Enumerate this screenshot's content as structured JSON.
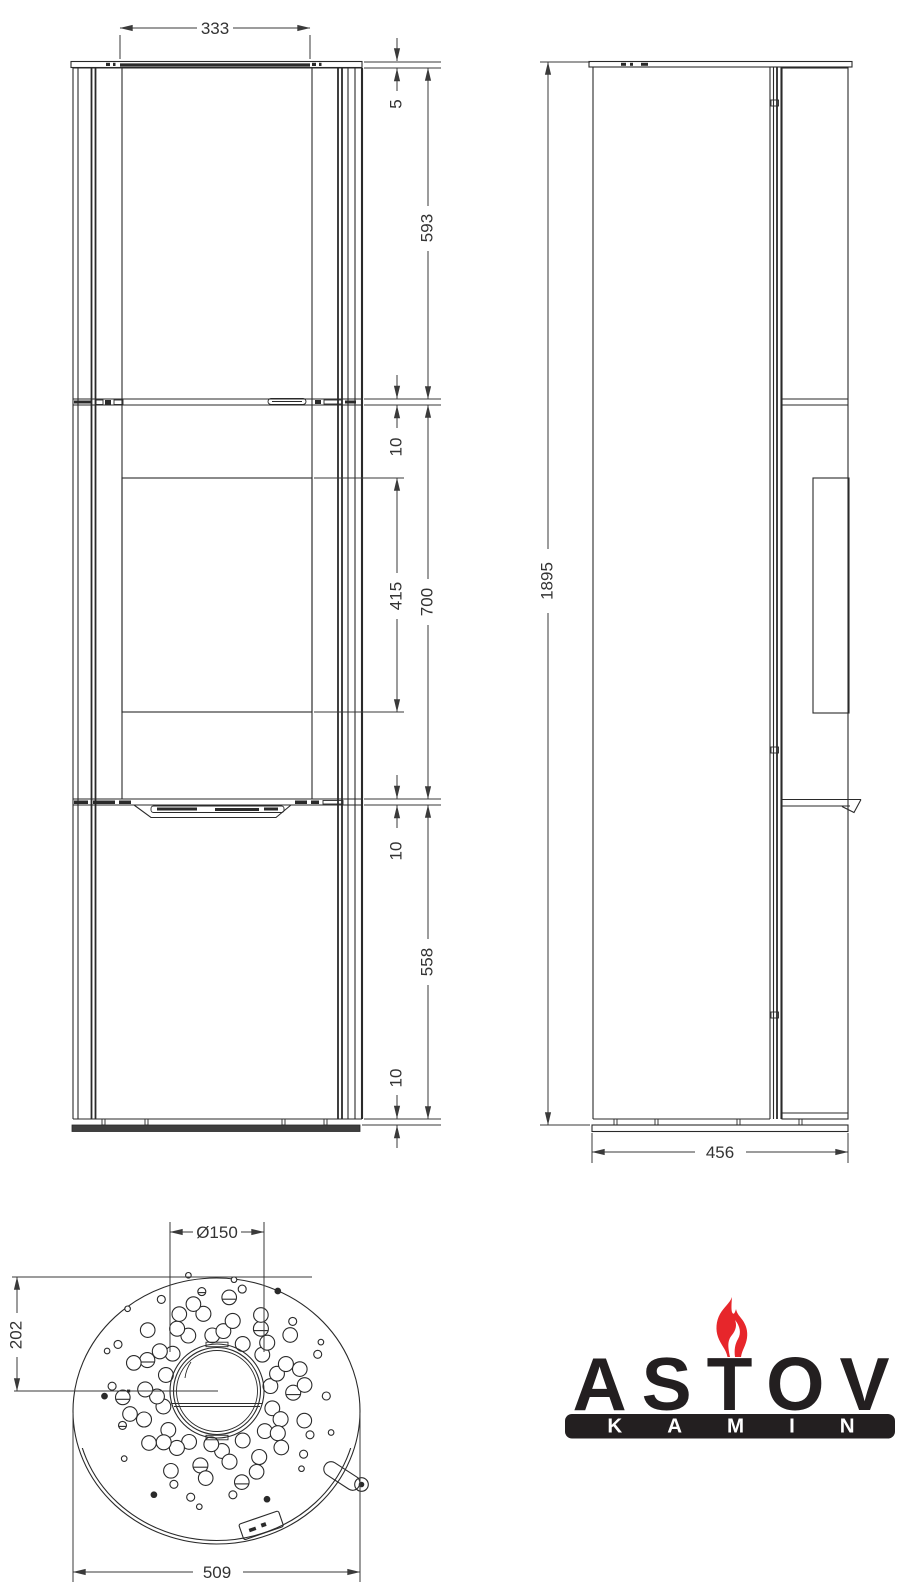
{
  "title": "Stove dimensional drawing",
  "colors": {
    "line": "#2a2a2a",
    "dim_text": "#333333",
    "logo_dark": "#231f20",
    "flame_red": "#e7262b",
    "base_fill": "#3f3f3f"
  },
  "views": {
    "front": {
      "name": "front-view",
      "dims": {
        "door_width": "333",
        "top_plate": "5",
        "upper_section": "593",
        "gap_upper": "10",
        "glass_height": "415",
        "middle_section": "700",
        "gap_lower": "10",
        "lower_section": "558",
        "base_gap": "10"
      }
    },
    "side": {
      "name": "side-view",
      "dims": {
        "height": "1895",
        "depth": "456"
      }
    },
    "top": {
      "name": "top-view",
      "dims": {
        "flue_diameter": "Ø150",
        "flue_offset": "202",
        "width": "509"
      }
    }
  },
  "logo": {
    "brand": "ASTOV",
    "subtitle": "KAMIN"
  },
  "perforation": {
    "rays": 18,
    "ray_step_deg": 20,
    "radii": [
      58,
      74,
      90,
      105,
      117
    ],
    "sizes": [
      9.5,
      7.5,
      6,
      4.5,
      2.5
    ],
    "center": {
      "x": 217,
      "y": 1391
    }
  }
}
